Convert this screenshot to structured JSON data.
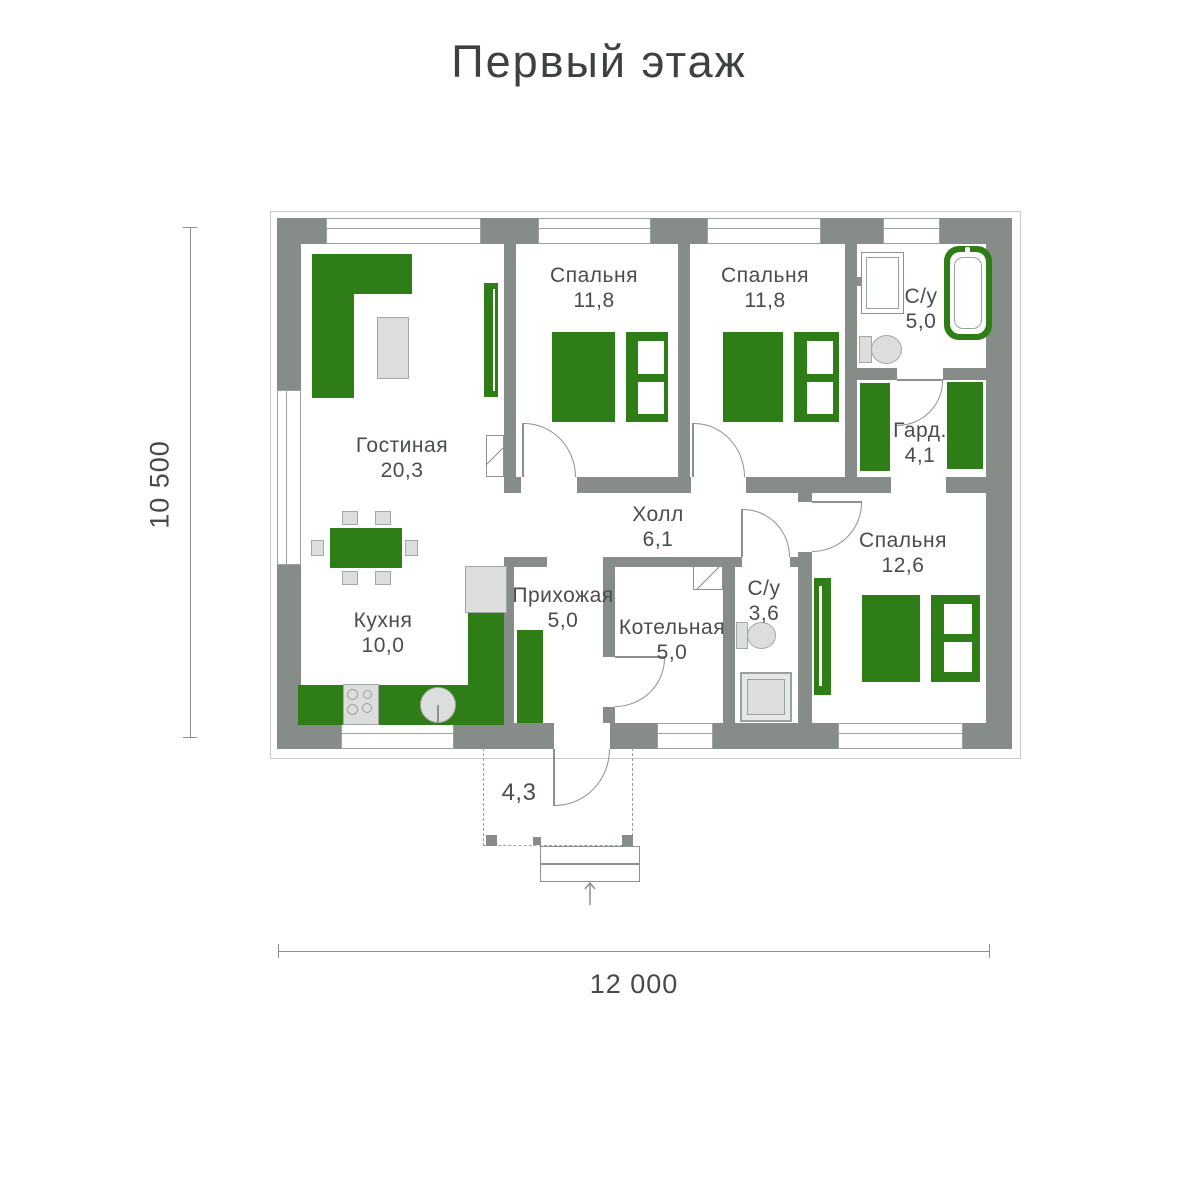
{
  "title": "Первый этаж",
  "dimensions": {
    "width": "12 000",
    "height": "10 500"
  },
  "rooms": [
    {
      "name": "Гостиная",
      "area": "20,3"
    },
    {
      "name": "Спальня",
      "area": "11,8"
    },
    {
      "name": "Спальня",
      "area": "11,8"
    },
    {
      "name": "С/у",
      "area": "5,0"
    },
    {
      "name": "Гард.",
      "area": "4,1"
    },
    {
      "name": "Холл",
      "area": "6,1"
    },
    {
      "name": "Спальня",
      "area": "12,6"
    },
    {
      "name": "Прихожая",
      "area": "5,0"
    },
    {
      "name": "Котельная",
      "area": "5,0"
    },
    {
      "name": "С/у",
      "area": "3,6"
    },
    {
      "name": "Кухня",
      "area": "10,0"
    }
  ],
  "porch": {
    "area": "4,3"
  },
  "colors": {
    "wall": "#868D89",
    "furniture_green": "#2E7D17",
    "furniture_grey": "#DBDEDC",
    "line": "#8A918E",
    "text": "#454B48"
  }
}
